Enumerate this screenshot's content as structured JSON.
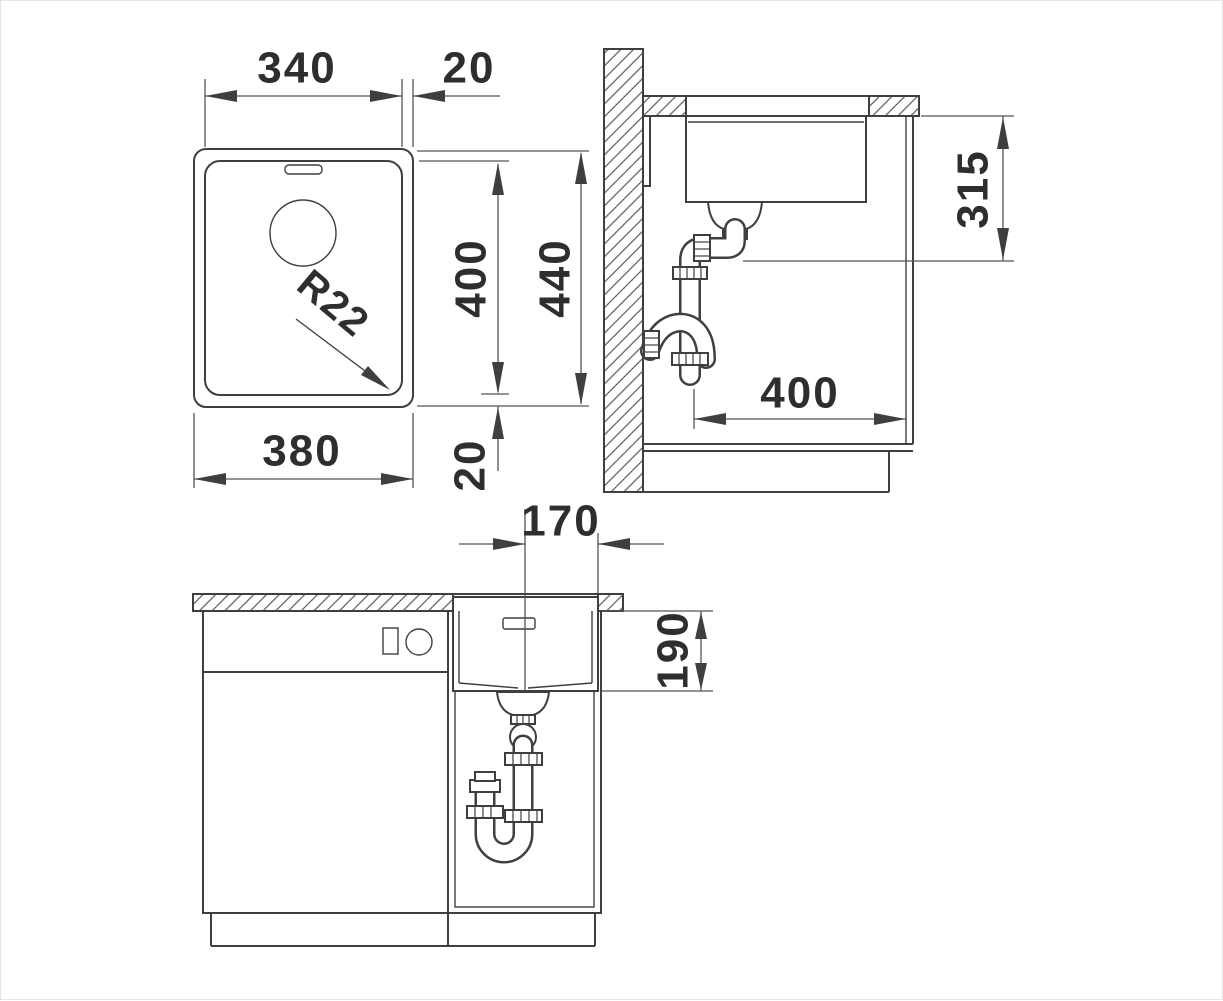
{
  "drawing": {
    "type": "sink installation technical drawing",
    "colors": {
      "line": "#3f3f3f",
      "thin_line": "#555555",
      "hatch": "#5a5a5a",
      "text": "#2e2e2e",
      "background": "#ffffff",
      "border": "#e6e6e6"
    },
    "views": {
      "plan": {
        "label": "Top view",
        "dims": {
          "basin_width": "340",
          "rim_side": "20",
          "basin_depth": "400",
          "overall_depth": "440",
          "overall_width": "380",
          "rim_front": "20",
          "corner_radius": "R22"
        }
      },
      "section": {
        "label": "Side section view",
        "dims": {
          "outlet_height": "315",
          "outlet_offset": "400"
        }
      },
      "front": {
        "label": "Front section view",
        "dims": {
          "drain_center_to_edge": "170",
          "basin_height": "190"
        }
      }
    }
  }
}
